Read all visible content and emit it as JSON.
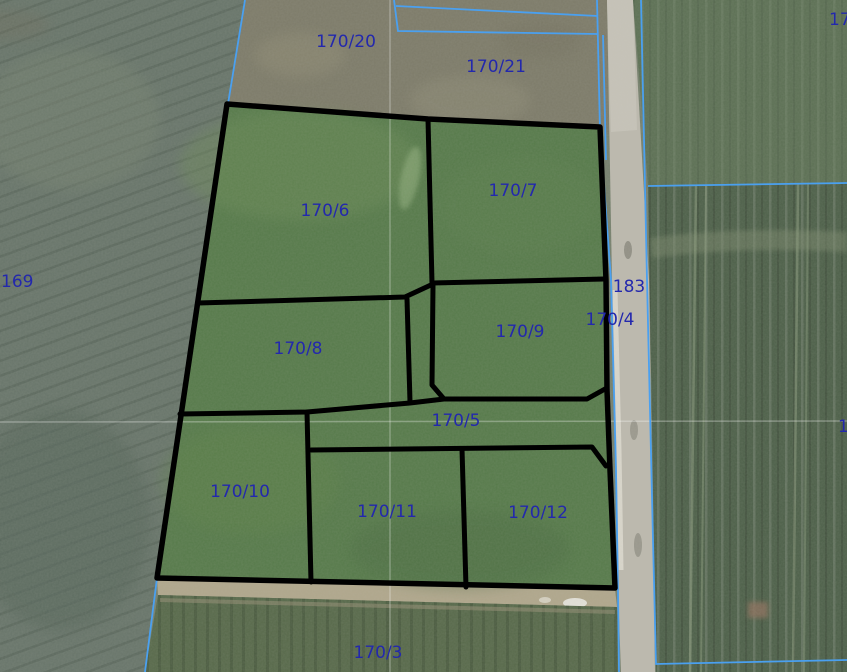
{
  "map": {
    "colors": {
      "parcel_label": "#2328ad",
      "cadastral_line": "#4aa0f0",
      "highlight_outline": "#000000",
      "highlight_fill": "#567a4a"
    },
    "parcels": [
      {
        "id": "169",
        "label": "169",
        "highlighted": false
      },
      {
        "id": "170/20",
        "label": "170/20",
        "highlighted": false
      },
      {
        "id": "170/21",
        "label": "170/21",
        "highlighted": false
      },
      {
        "id": "17",
        "label": "17",
        "highlighted": false,
        "truncated": true
      },
      {
        "id": "170/6",
        "label": "170/6",
        "highlighted": true
      },
      {
        "id": "170/7",
        "label": "170/7",
        "highlighted": true
      },
      {
        "id": "183",
        "label": "183",
        "highlighted": false
      },
      {
        "id": "170/4",
        "label": "170/4",
        "highlighted": false
      },
      {
        "id": "170/8",
        "label": "170/8",
        "highlighted": true
      },
      {
        "id": "170/9",
        "label": "170/9",
        "highlighted": true
      },
      {
        "id": "170/5",
        "label": "170/5",
        "highlighted": true
      },
      {
        "id": "170/10",
        "label": "170/10",
        "highlighted": true
      },
      {
        "id": "170/11",
        "label": "170/11",
        "highlighted": true
      },
      {
        "id": "170/12",
        "label": "170/12",
        "highlighted": true
      },
      {
        "id": "170/3",
        "label": "170/3",
        "highlighted": false
      },
      {
        "id": "1",
        "label": "1",
        "highlighted": false,
        "truncated": true
      }
    ]
  }
}
